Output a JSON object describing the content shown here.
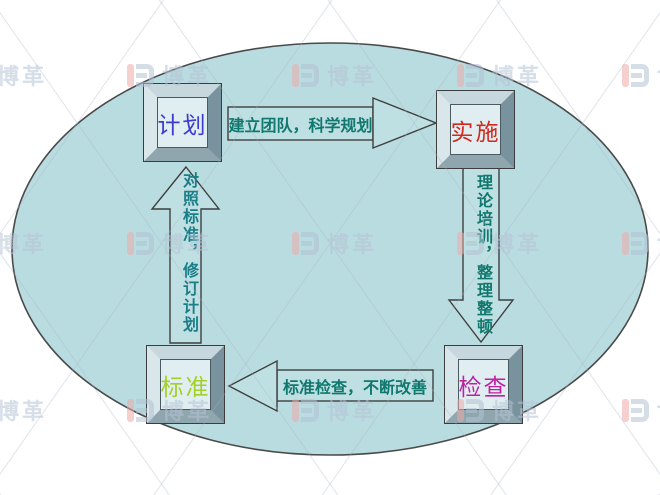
{
  "diagram": {
    "type": "pdca-cycle",
    "background_color": "#ffffff",
    "ellipse_fill": "#b9dce0",
    "arrow_fill": "#bfe0e3",
    "nodes": [
      {
        "id": "plan",
        "label": "计划",
        "color": "#3b3bd0"
      },
      {
        "id": "do",
        "label": "实施",
        "color": "#d3281e"
      },
      {
        "id": "check",
        "label": "检查",
        "color": "#bf1fa4"
      },
      {
        "id": "standard",
        "label": "标准",
        "color": "#a2d028"
      }
    ],
    "arrows": [
      {
        "id": "plan-to-do",
        "label": "建立团队，科学规划",
        "color": "#10786e"
      },
      {
        "id": "do-to-check",
        "label": "理论培训，整理整顿",
        "color": "#10786e"
      },
      {
        "id": "check-to-standard",
        "label": "标准检查，不断改善",
        "color": "#10786e"
      },
      {
        "id": "standard-to-plan",
        "label": "对照标准，修订计划",
        "color": "#1a7e88"
      }
    ]
  },
  "watermark": {
    "brand": "博革"
  }
}
